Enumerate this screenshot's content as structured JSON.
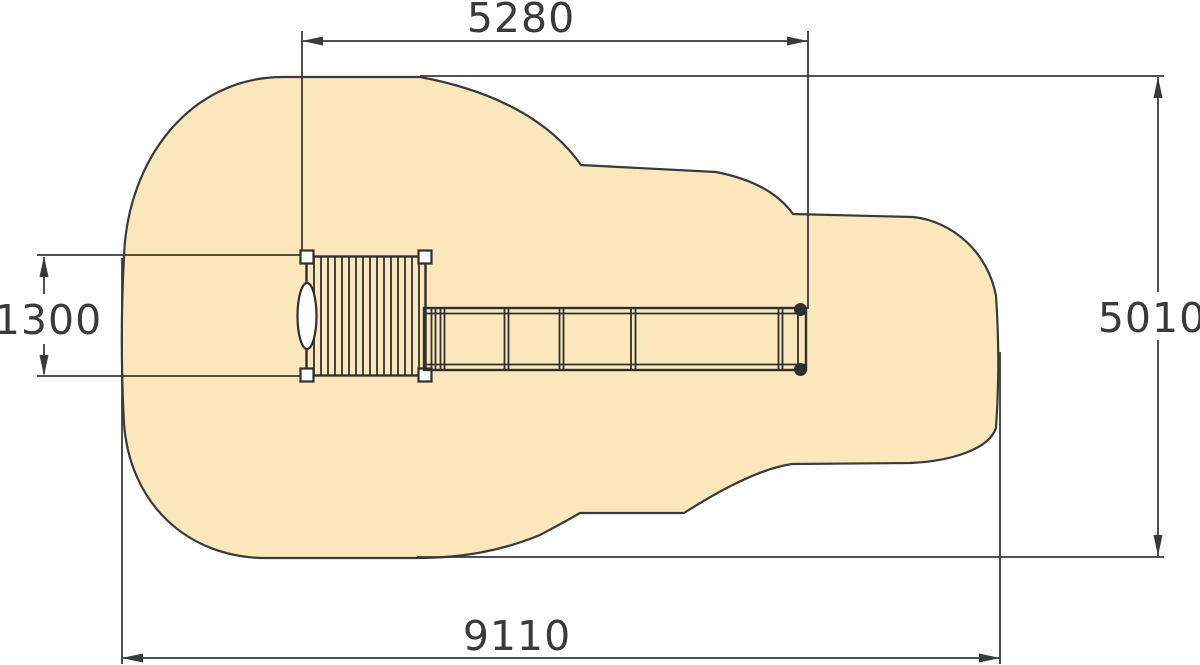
{
  "diagram": {
    "kind": "playground-equipment-plan-view-with-safety-zone",
    "dimensions": {
      "top_width": "5280",
      "platform_depth": "1300",
      "zone_height": "5010",
      "zone_width": "9110"
    },
    "colors": {
      "safety_zone_fill": "#FBE7BC",
      "line": "#3A3A3A",
      "equipment_fill": "#FFFFFF",
      "post_fill": "#2F2F2F",
      "background": "#FFFFFF"
    }
  }
}
